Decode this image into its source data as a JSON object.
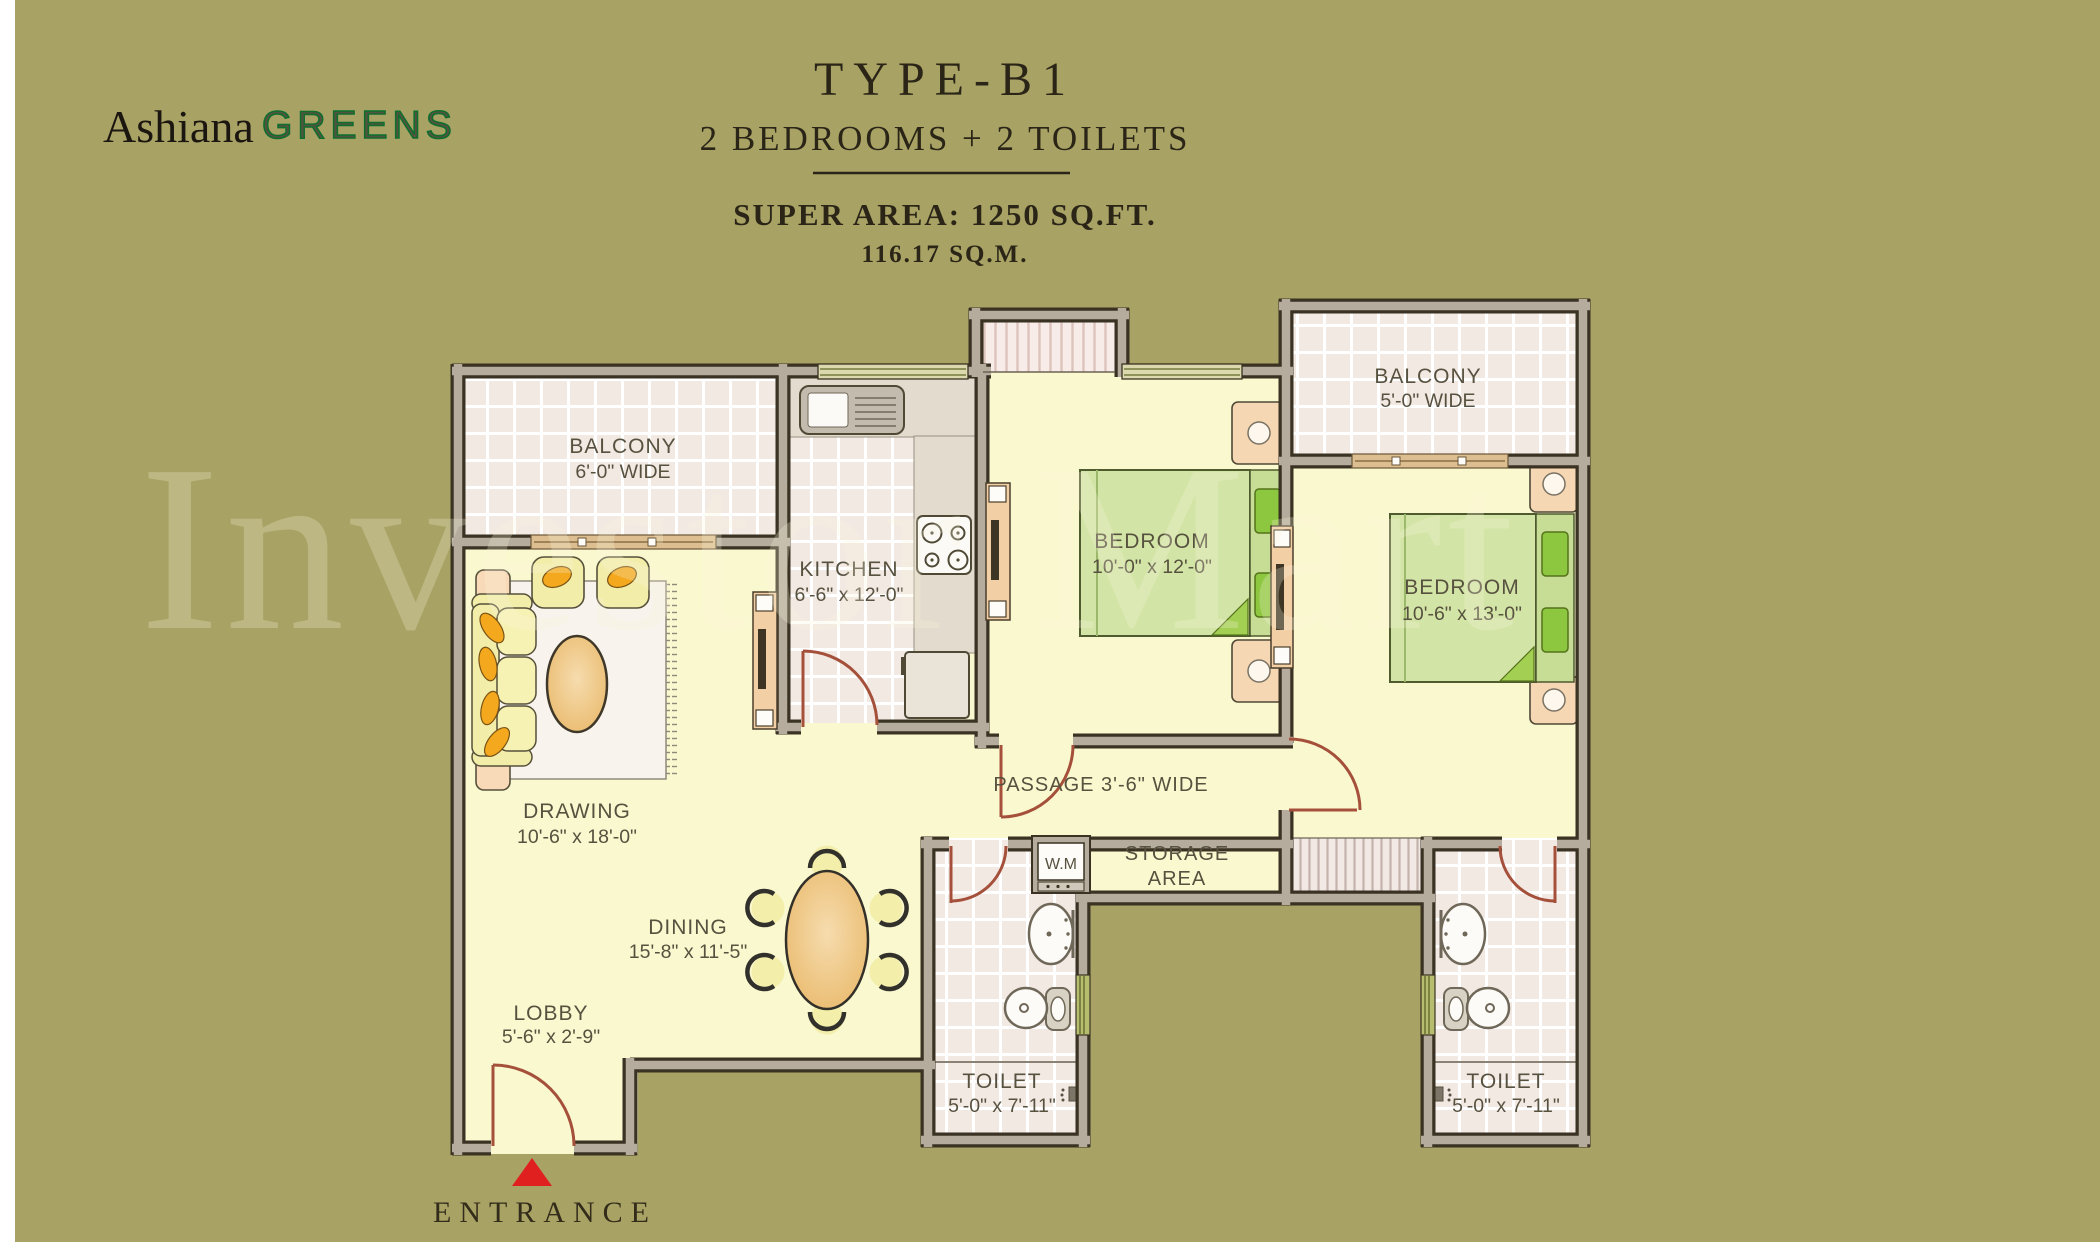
{
  "logo": {
    "brand": "Ashiana",
    "sub": "GREENS"
  },
  "header": {
    "type": "TYPE-B1",
    "subtitle": "2 BEDROOMS + 2 TOILETS",
    "super_area": "SUPER AREA: 1250 SQ.FT.",
    "metric_area": "116.17 SQ.M."
  },
  "watermark": "Investor Mart",
  "entrance_label": "ENTRANCE",
  "rooms": {
    "balcony_tl": {
      "name": "BALCONY",
      "dims": "6'-0\" WIDE"
    },
    "kitchen": {
      "name": "KITCHEN",
      "dims": "6'-6\" x 12'-0\""
    },
    "bedroom1": {
      "name": "BEDROOM",
      "dims": "10'-0\" x 12'-0\""
    },
    "balcony_tr": {
      "name": "BALCONY",
      "dims": "5'-0\" WIDE"
    },
    "bedroom2": {
      "name": "BEDROOM",
      "dims": "10'-6\" x 13'-0\""
    },
    "drawing": {
      "name": "DRAWING",
      "dims": "10'-6\" x 18'-0\""
    },
    "dining": {
      "name": "DINING",
      "dims": "15'-8\" x 11'-5\""
    },
    "lobby": {
      "name": "LOBBY",
      "dims": "5'-6\" x 2'-9\""
    },
    "passage": {
      "name": "PASSAGE 3'-6\" WIDE"
    },
    "storage": {
      "line1": "STORAGE",
      "line2": "AREA"
    },
    "toilet1": {
      "name": "TOILET",
      "dims": "5'-0\" x 7'-11\""
    },
    "toilet2": {
      "name": "TOILET",
      "dims": "5'-0\" x 7'-11\""
    },
    "washing_machine": {
      "label": "W.M"
    }
  },
  "colors": {
    "background": "#a8a264",
    "wall_core": "#b5ac9e",
    "wall_edge": "#3a3222",
    "floor": "#faf8cf",
    "tile": "#f2e9e3",
    "bed_green": "#d3e5a6",
    "pillow_green": "#8dc63f",
    "accent_orange": "#f3a81e",
    "door_red": "#a5503a",
    "entrance_marker": "#e01f1f",
    "logo_green": "#0f6e2e",
    "title_ink": "#2a2517"
  }
}
